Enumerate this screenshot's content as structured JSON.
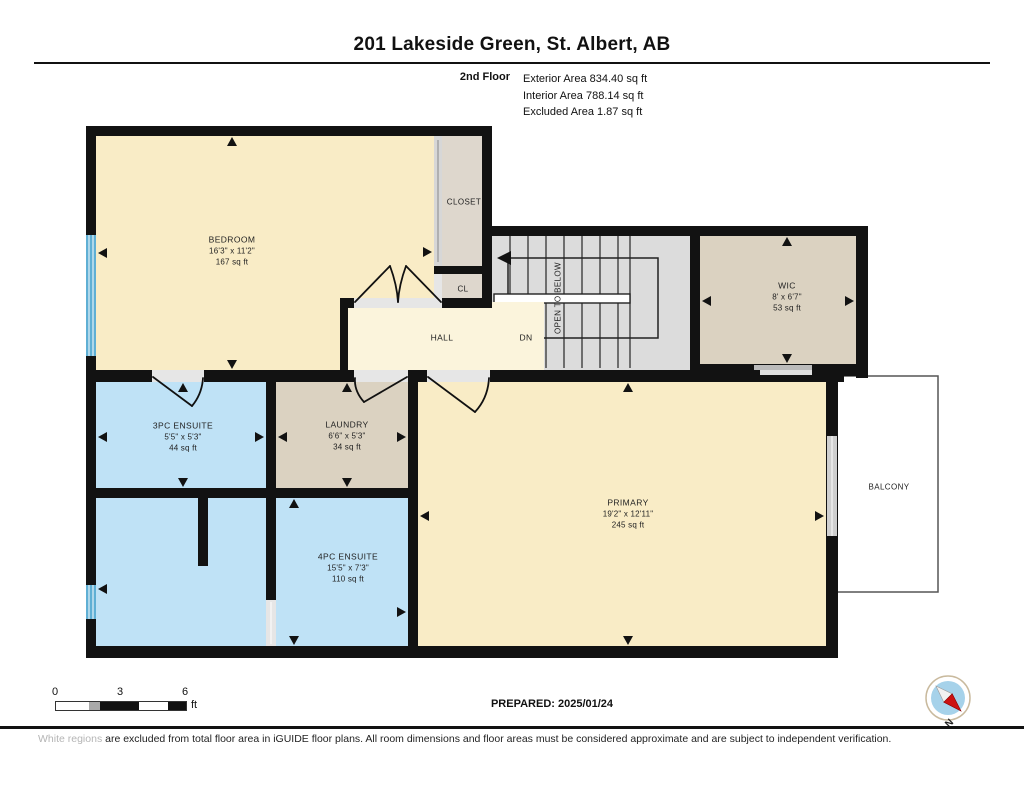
{
  "header": {
    "title": "201 Lakeside Green, St. Albert, AB",
    "floor_label": "2nd Floor",
    "areas": [
      "Exterior Area 834.40 sq ft",
      "Interior Area 788.14 sq ft",
      "Excluded Area 1.87 sq ft"
    ]
  },
  "rooms": {
    "bedroom": {
      "name": "BEDROOM",
      "dims": "16'3\" x 11'2\"",
      "area": "167 sq ft"
    },
    "closet": {
      "name": "CLOSET"
    },
    "cl": {
      "name": "CL"
    },
    "hall": {
      "name": "HALL"
    },
    "wic": {
      "name": "WIC",
      "dims": "8' x 6'7\"",
      "area": "53 sq ft"
    },
    "ensuite3": {
      "name": "3PC ENSUITE",
      "dims": "5'5\" x 5'3\"",
      "area": "44 sq ft"
    },
    "laundry": {
      "name": "LAUNDRY",
      "dims": "6'6\" x 5'3\"",
      "area": "34 sq ft"
    },
    "primary": {
      "name": "PRIMARY",
      "dims": "19'2\" x 12'11\"",
      "area": "245 sq ft"
    },
    "ensuite4": {
      "name": "4PC ENSUITE",
      "dims": "15'5\" x 7'3\"",
      "area": "110 sq ft"
    },
    "balcony": {
      "name": "BALCONY"
    }
  },
  "stairs": {
    "open_to_below": "OPEN TO BELOW",
    "dn": "DN"
  },
  "footer": {
    "scale": {
      "zero": "0",
      "three": "3",
      "six": "6",
      "unit": "ft"
    },
    "prepared": "PREPARED: 2025/01/24",
    "compass_n": "N",
    "disclaimer": {
      "light": "White regions",
      "rest": " are excluded from total floor area in iGUIDE floor plans. All room dimensions and floor areas must be considered approximate and are subject to independent verification."
    }
  },
  "colors": {
    "cream": "#F9ECC6",
    "hall": "#FBF4DC",
    "tan": "#DBD2C1",
    "closet": "#DED7CD",
    "bath": "#BFE2F6",
    "stair": "#DCDCDC",
    "wall": "#121212",
    "window": "#5FAFD4",
    "compass-blue": "#A6D2EA",
    "compass-red": "#CC1111"
  }
}
